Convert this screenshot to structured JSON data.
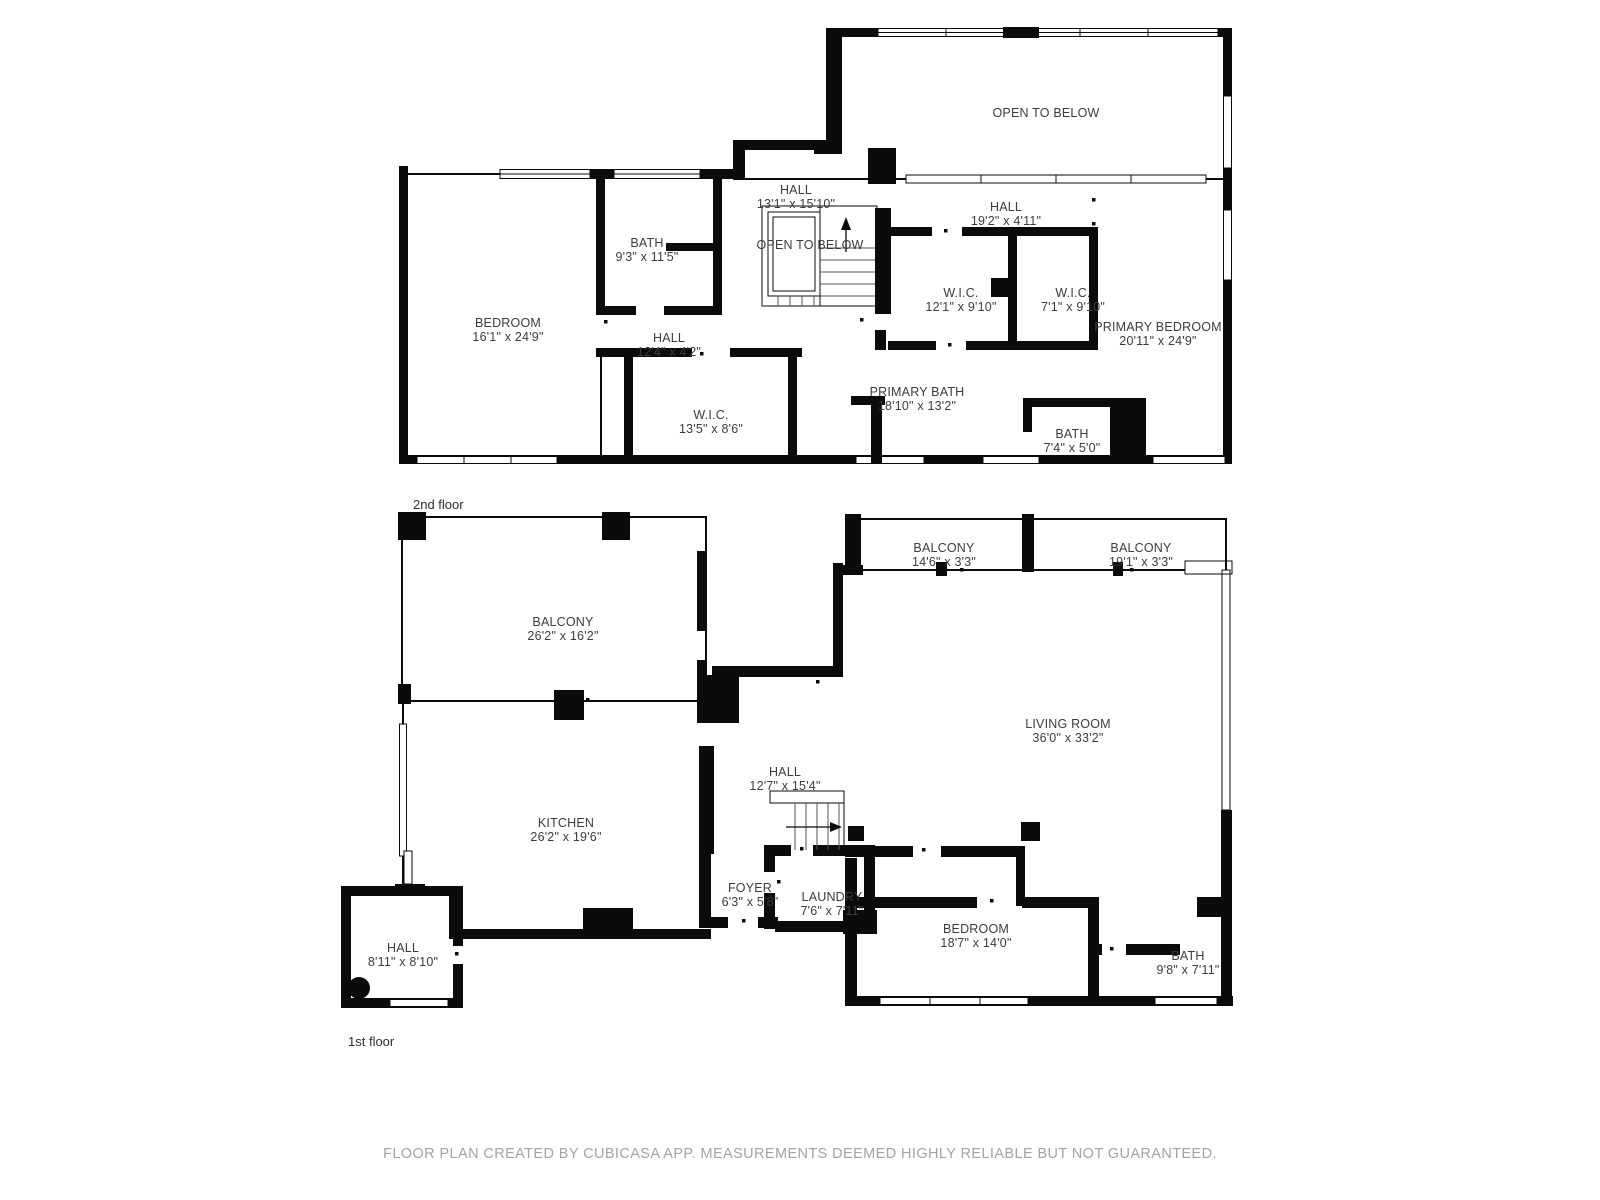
{
  "meta": {
    "wall_color": "#0b0b0b",
    "label_color": "#3c3c3c",
    "footer_color": "#a3a3a3",
    "background_color": "#ffffff"
  },
  "floors": [
    {
      "tag": "2nd floor",
      "rooms": [
        {
          "name": "OPEN TO BELOW",
          "dims": ""
        },
        {
          "name": "HALL",
          "dims": "13'1\" x 15'10\""
        },
        {
          "name": "OPEN TO BELOW",
          "dims": ""
        },
        {
          "name": "BATH",
          "dims": "9'3\" x 11'5\""
        },
        {
          "name": "HALL",
          "dims": "19'2\" x 4'11\""
        },
        {
          "name": "W.I.C.",
          "dims": "12'1\" x 9'10\""
        },
        {
          "name": "W.I.C.",
          "dims": "7'1\" x 9'10\""
        },
        {
          "name": "BEDROOM",
          "dims": "16'1\" x 24'9\""
        },
        {
          "name": "PRIMARY BEDROOM",
          "dims": "20'11\" x 24'9\""
        },
        {
          "name": "HALL",
          "dims": "12'4\" x 4'2\""
        },
        {
          "name": "W.I.C.",
          "dims": "13'5\" x 8'6\""
        },
        {
          "name": "PRIMARY BATH",
          "dims": "18'10\" x 13'2\""
        },
        {
          "name": "BATH",
          "dims": "7'4\" x 5'0\""
        }
      ]
    },
    {
      "tag": "1st floor",
      "rooms": [
        {
          "name": "BALCONY",
          "dims": "26'2\" x 16'2\""
        },
        {
          "name": "BALCONY",
          "dims": "14'6\" x 3'3\""
        },
        {
          "name": "BALCONY",
          "dims": "19'1\" x 3'3\""
        },
        {
          "name": "LIVING ROOM",
          "dims": "36'0\" x 33'2\""
        },
        {
          "name": "KITCHEN",
          "dims": "26'2\" x 19'6\""
        },
        {
          "name": "HALL",
          "dims": "12'7\" x 15'4\""
        },
        {
          "name": "FOYER",
          "dims": "6'3\" x 5'8\""
        },
        {
          "name": "LAUNDRY",
          "dims": "7'6\" x 7'11\""
        },
        {
          "name": "BEDROOM",
          "dims": "18'7\" x 14'0\""
        },
        {
          "name": "HALL",
          "dims": "8'11\" x 8'10\""
        },
        {
          "name": "BATH",
          "dims": "9'8\" x 7'11\""
        }
      ]
    }
  ],
  "footer": {
    "disclaimer": "FLOOR PLAN CREATED BY CUBICASA APP. MEASUREMENTS DEEMED HIGHLY RELIABLE BUT NOT GUARANTEED."
  }
}
